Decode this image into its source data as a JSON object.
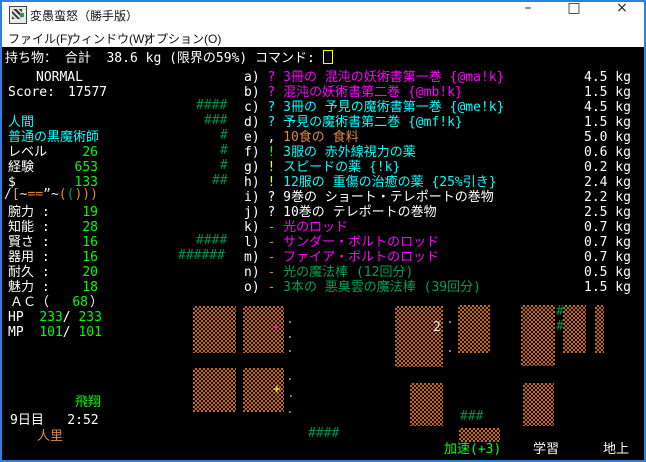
{
  "window": {
    "title": "変愚蛮怒（勝手版）",
    "controls": {
      "minimize": "–",
      "maximize": "□",
      "close": "×"
    }
  },
  "menu": {
    "items": [
      {
        "label": "ファイル(F)"
      },
      {
        "label": "ウィンドウ(W)"
      },
      {
        "label": "オプション(O)"
      }
    ]
  },
  "header": {
    "text": "持ち物： 合計  38.6 kg (限界の59%) コマンド: "
  },
  "status_panel": {
    "state": "NORMAL",
    "score_label": "Score:",
    "score_value": "17577",
    "race": "人間",
    "class": "普通の黒魔術師",
    "progress_rows": [
      {
        "label": "レベル",
        "value": "26"
      },
      {
        "label": "経験",
        "value": "653"
      },
      {
        "label": "$",
        "value": "133"
      }
    ],
    "equipment_chars": [
      {
        "ch": "/",
        "color": "#e8e8e8"
      },
      {
        "ch": "[",
        "color": "#d8a868"
      },
      {
        "ch": "~",
        "color": "#e8e8e8"
      },
      {
        "ch": "=",
        "color": "#e88030"
      },
      {
        "ch": "=",
        "color": "#e88030"
      },
      {
        "ch": "”",
        "color": "#e8e8e8"
      },
      {
        "ch": "~",
        "color": "#e8e8e8"
      },
      {
        "ch": "(",
        "color": "#e88030"
      },
      {
        "ch": "(",
        "color": "#00a050"
      },
      {
        "ch": ")",
        "color": "#e88030"
      },
      {
        "ch": ")",
        "color": "#e88030"
      },
      {
        "ch": ")",
        "color": "#e88030"
      }
    ],
    "stats": [
      {
        "label": "腕力 :",
        "value": "19"
      },
      {
        "label": "知能 :",
        "value": "28"
      },
      {
        "label": "賢さ :",
        "value": "16"
      },
      {
        "label": "器用 :",
        "value": "16"
      },
      {
        "label": "耐久 :",
        "value": "20"
      },
      {
        "label": "魅力 :",
        "value": "18"
      }
    ],
    "ac_label": "ＡＣ（",
    "ac_value": "68",
    "ac_close": "）",
    "hp_label": "HP",
    "hp_cur": "233",
    "hp_max": "233",
    "mp_label": "MP",
    "mp_cur": "101",
    "mp_max": "101"
  },
  "inventory": {
    "items": [
      {
        "letter": "a)",
        "symbol": "?",
        "symbol_color": "#ff00ff",
        "name": "3冊の 混沌の妖術書第一巻 {@ma!k}",
        "name_color": "#ff00ff",
        "weight": "4.5 kg"
      },
      {
        "letter": "b)",
        "symbol": "?",
        "symbol_color": "#ff00ff",
        "name": "混沌の妖術書第二巻 {@mb!k}",
        "name_color": "#ff00ff",
        "weight": "1.5 kg"
      },
      {
        "letter": "c)",
        "symbol": "?",
        "symbol_color": "#00ffff",
        "name": "3冊の 予見の魔術書第一巻 {@me!k}",
        "name_color": "#00ffff",
        "weight": "4.5 kg"
      },
      {
        "letter": "d)",
        "symbol": "?",
        "symbol_color": "#00ffff",
        "name": "予見の魔術書第二巻 {@mf!k}",
        "name_color": "#00ffff",
        "weight": "1.5 kg"
      },
      {
        "letter": "e)",
        "symbol": ",",
        "symbol_color": "#ffffff",
        "name": "10食の 食料",
        "name_color": "#dd8844",
        "weight": "5.0 kg"
      },
      {
        "letter": "f)",
        "symbol": "!",
        "symbol_color": "#00ff00",
        "name": "3服の 赤外線視力の薬",
        "name_color": "#00ffff",
        "weight": "0.6 kg"
      },
      {
        "letter": "g)",
        "symbol": "!",
        "symbol_color": "#ffff00",
        "name": "スピードの薬 {!k}",
        "name_color": "#00ffff",
        "weight": "0.2 kg"
      },
      {
        "letter": "h)",
        "symbol": "!",
        "symbol_color": "#ffff00",
        "name": "12服の 重傷の治癒の薬 {25%引き}",
        "name_color": "#00ffff",
        "weight": "2.4 kg"
      },
      {
        "letter": "i)",
        "symbol": "?",
        "symbol_color": "#ffffff",
        "name": "9巻の ショート・テレポートの巻物",
        "name_color": "#ffffff",
        "weight": "2.2 kg"
      },
      {
        "letter": "j)",
        "symbol": "?",
        "symbol_color": "#ffffff",
        "name": "10巻の テレポートの巻物",
        "name_color": "#ffffff",
        "weight": "2.5 kg"
      },
      {
        "letter": "k)",
        "symbol": "-",
        "symbol_color": "#e88030",
        "name": "光のロッド",
        "name_color": "#ff00ff",
        "weight": "0.7 kg"
      },
      {
        "letter": "l)",
        "symbol": "-",
        "symbol_color": "#e88030",
        "name": "サンダー・ボルトのロッド",
        "name_color": "#ff00ff",
        "weight": "0.7 kg"
      },
      {
        "letter": "m)",
        "symbol": "-",
        "symbol_color": "#e88030",
        "name": "ファイア・ボルトのロッド",
        "name_color": "#ff00ff",
        "weight": "0.7 kg"
      },
      {
        "letter": "n)",
        "symbol": "-",
        "symbol_color": "#e88030",
        "name": "光の魔法棒 (12回分)",
        "name_color": "#00a050",
        "weight": "0.5 kg"
      },
      {
        "letter": "o)",
        "symbol": "-",
        "symbol_color": "#e88030",
        "name": "3本の 悪臭雲の魔法棒 (39回分)",
        "name_color": "#00a050",
        "weight": "1.5 kg"
      }
    ]
  },
  "map": {
    "blocks": [
      {
        "x": 193,
        "y": 306,
        "w": 43,
        "h": 47
      },
      {
        "x": 243,
        "y": 306,
        "w": 41,
        "h": 47
      },
      {
        "x": 395,
        "y": 306,
        "w": 48,
        "h": 61
      },
      {
        "x": 458,
        "y": 305,
        "w": 32,
        "h": 48
      },
      {
        "x": 521,
        "y": 305,
        "w": 34,
        "h": 61
      },
      {
        "x": 563,
        "y": 305,
        "w": 23,
        "h": 48
      },
      {
        "x": 595,
        "y": 305,
        "w": 9,
        "h": 48
      },
      {
        "x": 193,
        "y": 368,
        "w": 43,
        "h": 44
      },
      {
        "x": 243,
        "y": 368,
        "w": 41,
        "h": 44
      },
      {
        "x": 410,
        "y": 383,
        "w": 33,
        "h": 43
      },
      {
        "x": 523,
        "y": 383,
        "w": 31,
        "h": 43
      },
      {
        "x": 459,
        "y": 428,
        "w": 41,
        "h": 14
      }
    ],
    "glyphs": [
      {
        "text": "####",
        "x": 196,
        "y": 99,
        "color": "#009048"
      },
      {
        "text": "###",
        "x": 204,
        "y": 114,
        "color": "#009048"
      },
      {
        "text": "#",
        "x": 220,
        "y": 129,
        "color": "#009048"
      },
      {
        "text": "#",
        "x": 220,
        "y": 144,
        "color": "#009048"
      },
      {
        "text": "#",
        "x": 220,
        "y": 159,
        "color": "#009048"
      },
      {
        "text": "##",
        "x": 212,
        "y": 174,
        "color": "#009048"
      },
      {
        "text": "####",
        "x": 196,
        "y": 234,
        "color": "#009048"
      },
      {
        "text": "######",
        "x": 178,
        "y": 249,
        "color": "#009048"
      },
      {
        "text": "####",
        "x": 308,
        "y": 427,
        "color": "#009048"
      },
      {
        "text": "###",
        "x": 460,
        "y": 410,
        "color": "#009048"
      },
      {
        "text": "#",
        "x": 556,
        "y": 305,
        "color": "#009048"
      },
      {
        "text": "#",
        "x": 556,
        "y": 320,
        "color": "#009048"
      },
      {
        "text": "+",
        "x": 272,
        "y": 321,
        "color": "#ff00ff"
      },
      {
        "text": "+",
        "x": 273,
        "y": 383,
        "color": "#ffff00"
      },
      {
        "text": "2",
        "x": 433,
        "y": 321,
        "color": "#e8e8e8"
      },
      {
        "text": ".",
        "x": 286,
        "y": 313,
        "color": "#999999"
      },
      {
        "text": ".",
        "x": 286,
        "y": 328,
        "color": "#999999"
      },
      {
        "text": ".",
        "x": 286,
        "y": 342,
        "color": "#999999"
      },
      {
        "text": ".",
        "x": 446,
        "y": 313,
        "color": "#999999"
      },
      {
        "text": ".",
        "x": 446,
        "y": 342,
        "color": "#999999"
      },
      {
        "text": ".",
        "x": 286,
        "y": 370,
        "color": "#999999"
      },
      {
        "text": ".",
        "x": 287,
        "y": 387,
        "color": "#999999"
      },
      {
        "text": ".",
        "x": 286,
        "y": 403,
        "color": "#00e050"
      }
    ]
  },
  "bottom": {
    "fly": "飛翔",
    "day": "9日目   2:52",
    "location": "人里",
    "speed": "加速(+3)",
    "study": "学習",
    "depth": "地上"
  },
  "colors": {
    "frame_blue": "#2b82d9",
    "terminal_bg": "#000000",
    "white": "#ffffff",
    "magenta": "#ff00ff",
    "cyan": "#00ffff",
    "bright_green": "#00ff00",
    "item_green": "#00a050",
    "tree_green": "#009048",
    "umber": "#dd8844",
    "orange": "#e88030",
    "yellow": "#ffff00",
    "wall_brown": "#bc6a1f"
  }
}
